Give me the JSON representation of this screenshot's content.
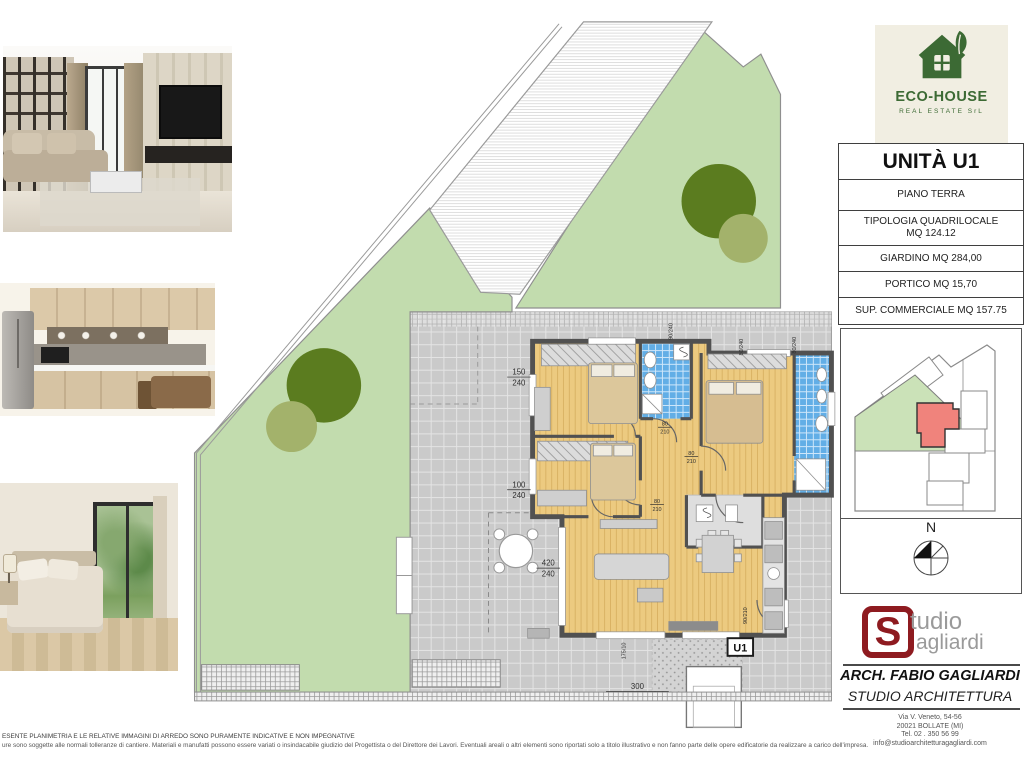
{
  "colors": {
    "garden": "#c2dcae",
    "treedark": "#5b7c1f",
    "treelight": "#a3b26b",
    "patio": "#cacaca",
    "floor": "#ecca80",
    "bath": "#62aee6",
    "wall": "#515151",
    "mapgreen": "#cbe2b8",
    "unitred": "#f0837c",
    "ecogreen": "#3c6a34",
    "ecobg": "#f1eee2",
    "studiored": "#8e1b20"
  },
  "eco_logo": {
    "title": "ECO-HOUSE",
    "subtitle": "REAL ESTATE SrL"
  },
  "unit_panel": {
    "title": "UNITÀ U1",
    "rows": [
      "PIANO TERRA",
      "TIPOLOGIA QUADRILOCALE\nMQ 124.12",
      "GIARDINO MQ 284,00",
      "PORTICO MQ 15,70",
      "SUP. COMMERCIALE MQ 157.75"
    ]
  },
  "compass": {
    "north": "N"
  },
  "studio_logo": {
    "initial": "S",
    "word1": "tudio",
    "word2": "agliardi"
  },
  "architect": {
    "name": "ARCH. FABIO GAGLIARDI",
    "studio": "STUDIO ARCHITETTURA",
    "address": [
      "Via V. Veneto, 54-56",
      "20021 BOLLATE (MI)",
      "Tel. 02 . 350 56 99",
      "info@studioarchitetturagagliardi.com"
    ]
  },
  "plan": {
    "unit_label": "U1",
    "dim_150": {
      "w": "150",
      "h": "240"
    },
    "dim_100": {
      "w": "100",
      "h": "240"
    },
    "dim_420": {
      "w": "420",
      "h": "240"
    },
    "dim_300": "300",
    "door_dim": {
      "w": "80",
      "h": "210"
    },
    "entry_dim": "90/210",
    "win_dim_a": "90/240",
    "win_dim_b": "80/240",
    "side_dim": "175/10"
  },
  "footer": {
    "line1": "ESENTE PLANIMETRIA E LE RELATIVE IMMAGINI DI ARREDO SONO PURAMENTE INDICATIVE E NON IMPEGNATIVE",
    "line2": "ure sono soggette alle normali tolleranze di cantiere. Materiali e manufatti possono essere variati o insindacabile giudizio del Progettista o del Direttore dei Lavori. Eventuali areali o altri elementi sono riportati solo a titolo illustrativo e non fanno parte delle opere edificatorie da realizzare a carico dell'impresa."
  }
}
